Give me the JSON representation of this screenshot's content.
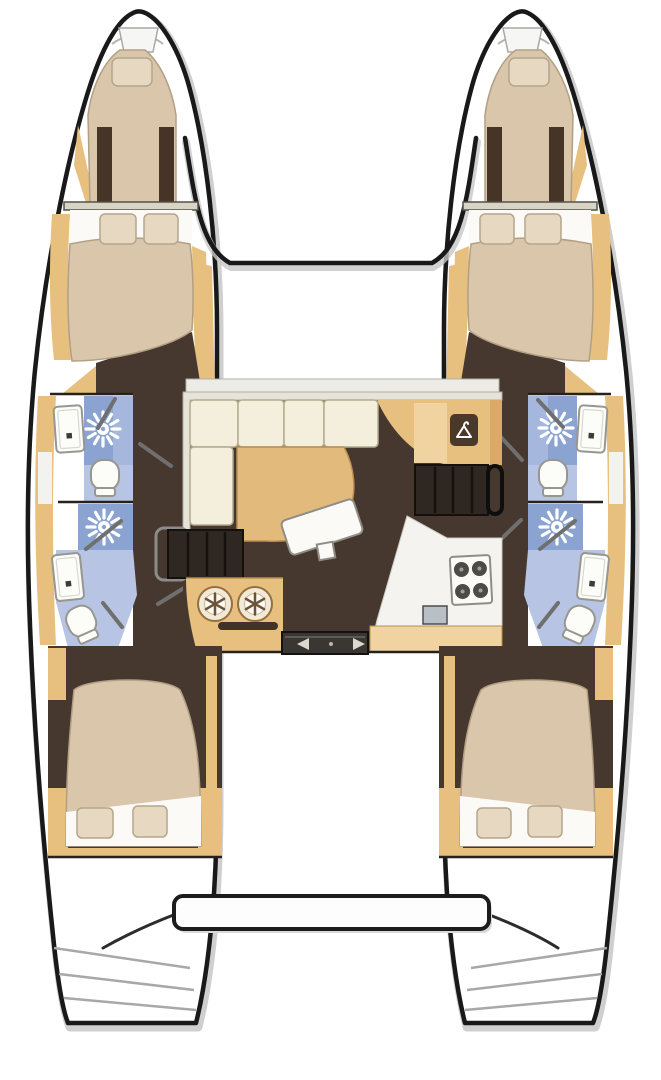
{
  "meta": {
    "diagram_type": "catamaran-floor-plan",
    "view": "top-down"
  },
  "colors": {
    "hull_outline": "#191919",
    "hull_shadow": "#c7c7c7",
    "deck_white": "#ffffff",
    "wood_trim": "#e7c07f",
    "wood_light": "#f0d3a0",
    "floor_dark": "#46382f",
    "panel_dark": "#463527",
    "bed": "#d9c6ab",
    "bed_edge": "#b3a084",
    "linen": "#fbfaf6",
    "pillow": "#e7d8c2",
    "pillow_edge": "#b5a68c",
    "cushion": "#f4eedc",
    "cushion_edge": "#b4ab8e",
    "backrest": "#e6e3d9",
    "shower_blue": "#8aa3d0",
    "shower_blue_light": "#a5b7dd",
    "bath_floor": "#b7c4e3",
    "fixture": "#fcfcf9",
    "fixture_edge": "#97978f",
    "counter": "#f4f3ef",
    "sink_gray": "#b9bfc7",
    "burner": "#4e4a46",
    "wall": "#26211d",
    "door_bar": "#6f6f6f",
    "steps": "#2f2721",
    "tread": "#16110d",
    "glass": "#ecebe6",
    "table": "#e2ba7c",
    "slide_door": "#3a3632",
    "arrow": "#ddd8cf"
  },
  "areas": {
    "port_hull": {
      "label": "Port hull"
    },
    "starboard_hull": {
      "label": "Starboard hull"
    },
    "foredeck": {
      "label": "Foredeck between bows"
    },
    "port_forepeak": {
      "label": "Port forepeak berth"
    },
    "starboard_forepeak": {
      "label": "Starboard forepeak berth"
    },
    "port_forward_cabin": {
      "label": "Port forward double cabin"
    },
    "starboard_forward_cabin": {
      "label": "Starboard forward double cabin"
    },
    "port_forward_head": {
      "label": "Port forward bathroom with shower, sink and toilet"
    },
    "port_aft_head": {
      "label": "Port aft bathroom with shower, sink and toilet"
    },
    "starboard_forward_head": {
      "label": "Starboard forward bathroom with shower, sink and toilet"
    },
    "starboard_aft_head": {
      "label": "Starboard aft bathroom with shower, sink and toilet"
    },
    "port_aft_cabin": {
      "label": "Port aft double cabin"
    },
    "starboard_aft_cabin": {
      "label": "Starboard aft double cabin"
    },
    "saloon": {
      "label": "Saloon with L-shaped sofa, table and wardrobe"
    },
    "galley": {
      "label": "Aft galley with double sink and four-burner stove"
    },
    "companionway_port": {
      "label": "Steps down to port hull"
    },
    "companionway_starboard": {
      "label": "Steps down to starboard hull"
    },
    "sliding_door": {
      "label": "Sliding door to cockpit"
    },
    "cockpit": {
      "label": "Aft cockpit"
    },
    "aft_platform": {
      "label": "Aft crossbeam platform"
    }
  },
  "icons": {
    "shower_head": "sunburst shower rose",
    "wardrobe_hanger": "clothes hanger",
    "door_arrows": "sliding door direction arrows"
  }
}
